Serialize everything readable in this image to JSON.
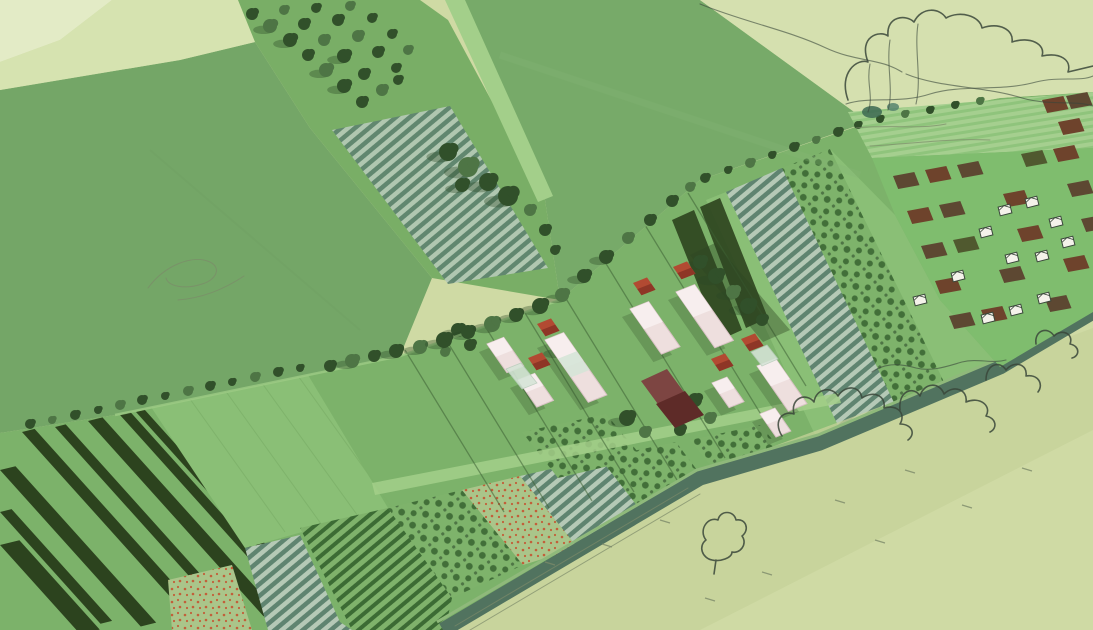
{
  "meta": {
    "title": "Agricultural masterplan aerial illustration",
    "description": "Hand-drawn style aerial perspective of a diagonal productive-landscape strip: striped field plots, orchards, polytunnels, allotments with sheds, farm courtyard buildings, hedgerows and sketched trees over pale meadow.",
    "type": "illustration",
    "has_text": false
  },
  "palette": {
    "paleBg": "#cfdaa4",
    "paleShade": "#c6d29a",
    "paleNE": "#d5e0af",
    "paleField1": "#e3ebc6",
    "paleField2": "#d6e3b0",
    "fieldGreen": "#74a667",
    "fieldGreenE": "#77aa69",
    "lightPath": "#a3cf8a",
    "stripGreen": "#7cb26a",
    "stripLight": "#8abf76",
    "darkStripe": "#2c431e",
    "hedge": "#3e6135",
    "treeDark": "#31502a",
    "treeMid": "#4e7545",
    "treeShadow": "#2c4724",
    "ridgeGreyDark": "#5f8470",
    "ridgeGreyLight": "#b5c9b6",
    "ridgeGreenDark": "#3c6b34",
    "ridgeGreenLight": "#7fb26b",
    "orchardBase": "#7eb36b",
    "orchardDot": "#426f39",
    "flowerBase": "#aac58a",
    "flowerDot": "#c25f3a",
    "allotGreen": "#7fbd6e",
    "brown1": "#5d4832",
    "brown2": "#6e432c",
    "brown3": "#50592f",
    "barnPink": "#eedfde",
    "barnTop": "#f7f0ef",
    "barnShade": "#d9c3c5",
    "glass": "#d5e4d7",
    "roofRed": "#b24a32",
    "roofRedDark": "#8e3626",
    "maroon": "#7d4542",
    "maroonDark": "#5e2b28",
    "bank": "#51735f",
    "bankHi": "#8fb97b",
    "ink": "#39463a",
    "faintInk": "#7c8a6a",
    "gStreakBase": "#a5cf8f",
    "gStreakLine": "#8fc47c",
    "shedWhite": "#f4f2ea"
  },
  "scene": {
    "stripes": [
      {
        "x": 22,
        "y": 432,
        "w": 13,
        "l": 235
      },
      {
        "x": 55,
        "y": 427,
        "w": 11,
        "l": 250
      },
      {
        "x": 88,
        "y": 421,
        "w": 15,
        "l": 262
      },
      {
        "x": 120,
        "y": 415,
        "w": 11,
        "l": 272
      },
      {
        "x": 136,
        "y": 412,
        "w": 9,
        "l": 280
      },
      {
        "x": 0,
        "y": 470,
        "w": 16,
        "l": 210
      },
      {
        "x": 0,
        "y": 512,
        "w": 12,
        "l": 150
      },
      {
        "x": 0,
        "y": 545,
        "w": 20,
        "l": 120
      }
    ],
    "barns": [
      {
        "x": 487,
        "y": 344,
        "l": 35,
        "w": 18
      },
      {
        "x": 545,
        "y": 340,
        "l": 76,
        "w": 20,
        "g": true
      },
      {
        "x": 518,
        "y": 380,
        "l": 33,
        "w": 18
      },
      {
        "x": 630,
        "y": 309,
        "l": 55,
        "w": 20
      },
      {
        "x": 676,
        "y": 292,
        "l": 68,
        "w": 20
      },
      {
        "x": 757,
        "y": 366,
        "l": 55,
        "w": 20
      },
      {
        "x": 712,
        "y": 383,
        "l": 30,
        "w": 16
      },
      {
        "x": 760,
        "y": 414,
        "l": 28,
        "w": 16
      }
    ],
    "glasshouses": [
      {
        "pts": "506,369 521,363 537,383 522,389"
      },
      {
        "pts": "751,352 767,345 778,359 762,366"
      }
    ],
    "cubes": [
      {
        "x": 537,
        "y": 324
      },
      {
        "x": 528,
        "y": 358
      },
      {
        "x": 633,
        "y": 283
      },
      {
        "x": 673,
        "y": 267
      },
      {
        "x": 711,
        "y": 359
      },
      {
        "x": 741,
        "y": 339
      }
    ],
    "maroon": {
      "body": "641,381 667,369 689,399 663,411",
      "gable": "656,404 685,391 704,415 675,428"
    },
    "sheds": [
      {
        "x": 1005,
        "y": 210
      },
      {
        "x": 1032,
        "y": 202
      },
      {
        "x": 1056,
        "y": 222
      },
      {
        "x": 986,
        "y": 232
      },
      {
        "x": 1012,
        "y": 258
      },
      {
        "x": 1042,
        "y": 256
      },
      {
        "x": 1068,
        "y": 242
      },
      {
        "x": 958,
        "y": 276
      },
      {
        "x": 988,
        "y": 318
      },
      {
        "x": 1016,
        "y": 310
      },
      {
        "x": 1044,
        "y": 298
      },
      {
        "x": 920,
        "y": 300
      }
    ],
    "patches": [
      {
        "x": 893,
        "y": 176,
        "c": "brown1"
      },
      {
        "x": 925,
        "y": 170,
        "c": "brown2"
      },
      {
        "x": 957,
        "y": 165,
        "c": "brown1"
      },
      {
        "x": 1021,
        "y": 154,
        "c": "brown3"
      },
      {
        "x": 1053,
        "y": 149,
        "c": "brown2"
      },
      {
        "x": 907,
        "y": 211,
        "c": "brown2"
      },
      {
        "x": 939,
        "y": 205,
        "c": "brown1"
      },
      {
        "x": 1003,
        "y": 194,
        "c": "brown2"
      },
      {
        "x": 1067,
        "y": 184,
        "c": "brown1"
      },
      {
        "x": 921,
        "y": 246,
        "c": "brown1"
      },
      {
        "x": 953,
        "y": 240,
        "c": "brown3"
      },
      {
        "x": 1017,
        "y": 229,
        "c": "brown2"
      },
      {
        "x": 1081,
        "y": 219,
        "c": "brown1"
      },
      {
        "x": 935,
        "y": 281,
        "c": "brown2"
      },
      {
        "x": 999,
        "y": 270,
        "c": "brown1"
      },
      {
        "x": 1063,
        "y": 259,
        "c": "brown2"
      },
      {
        "x": 949,
        "y": 316,
        "c": "brown1"
      },
      {
        "x": 981,
        "y": 310,
        "c": "brown2"
      },
      {
        "x": 1045,
        "y": 299,
        "c": "brown1"
      },
      {
        "x": 1042,
        "y": 100,
        "c": "brown2"
      },
      {
        "x": 1066,
        "y": 96,
        "c": "brown1"
      },
      {
        "x": 1058,
        "y": 122,
        "c": "brown2"
      }
    ],
    "trees_strip": [
      {
        "x": 458,
        "y": 330,
        "r": 7,
        "c": "d"
      },
      {
        "x": 470,
        "y": 345,
        "r": 6,
        "c": "d"
      },
      {
        "x": 445,
        "y": 352,
        "r": 5,
        "c": "m"
      },
      {
        "x": 560,
        "y": 350,
        "r": 7,
        "c": "m"
      },
      {
        "x": 578,
        "y": 366,
        "r": 6,
        "c": "d"
      },
      {
        "x": 700,
        "y": 262,
        "r": 7,
        "c": "d"
      },
      {
        "x": 716,
        "y": 276,
        "r": 8,
        "c": "d"
      },
      {
        "x": 733,
        "y": 292,
        "r": 7,
        "c": "m"
      },
      {
        "x": 748,
        "y": 306,
        "r": 8,
        "c": "d"
      },
      {
        "x": 762,
        "y": 320,
        "r": 6,
        "c": "d"
      },
      {
        "x": 627,
        "y": 418,
        "r": 8,
        "c": "d"
      },
      {
        "x": 645,
        "y": 432,
        "r": 6,
        "c": "m"
      },
      {
        "x": 695,
        "y": 400,
        "r": 7,
        "c": "d"
      },
      {
        "x": 710,
        "y": 418,
        "r": 6,
        "c": "m"
      },
      {
        "x": 680,
        "y": 430,
        "r": 6,
        "c": "d"
      }
    ],
    "trees_cover": [
      {
        "x": 30,
        "y": 424,
        "r": 5,
        "c": "d"
      },
      {
        "x": 52,
        "y": 420,
        "r": 4,
        "c": "m"
      },
      {
        "x": 75,
        "y": 415,
        "r": 5,
        "c": "d"
      },
      {
        "x": 98,
        "y": 410,
        "r": 4,
        "c": "d"
      },
      {
        "x": 120,
        "y": 405,
        "r": 5,
        "c": "m"
      },
      {
        "x": 142,
        "y": 400,
        "r": 5,
        "c": "d"
      },
      {
        "x": 165,
        "y": 396,
        "r": 4,
        "c": "d"
      },
      {
        "x": 188,
        "y": 391,
        "r": 5,
        "c": "m"
      },
      {
        "x": 210,
        "y": 386,
        "r": 5,
        "c": "d"
      },
      {
        "x": 232,
        "y": 382,
        "r": 4,
        "c": "d"
      },
      {
        "x": 255,
        "y": 377,
        "r": 5,
        "c": "m"
      },
      {
        "x": 278,
        "y": 372,
        "r": 5,
        "c": "d"
      },
      {
        "x": 300,
        "y": 368,
        "r": 4,
        "c": "d"
      },
      {
        "x": 330,
        "y": 366,
        "r": 6,
        "c": "d"
      },
      {
        "x": 352,
        "y": 361,
        "r": 7,
        "c": "m"
      },
      {
        "x": 374,
        "y": 356,
        "r": 6,
        "c": "d"
      },
      {
        "x": 396,
        "y": 351,
        "r": 7,
        "c": "d"
      },
      {
        "x": 420,
        "y": 347,
        "r": 7,
        "c": "m"
      },
      {
        "x": 444,
        "y": 340,
        "r": 8,
        "c": "d"
      },
      {
        "x": 468,
        "y": 332,
        "r": 7,
        "c": "d"
      },
      {
        "x": 492,
        "y": 324,
        "r": 8,
        "c": "m"
      },
      {
        "x": 516,
        "y": 315,
        "r": 7,
        "c": "d"
      },
      {
        "x": 540,
        "y": 306,
        "r": 8,
        "c": "d"
      },
      {
        "x": 562,
        "y": 295,
        "r": 7,
        "c": "m"
      },
      {
        "x": 584,
        "y": 276,
        "r": 7,
        "c": "d"
      },
      {
        "x": 606,
        "y": 257,
        "r": 7,
        "c": "d"
      },
      {
        "x": 628,
        "y": 238,
        "r": 6,
        "c": "m"
      },
      {
        "x": 650,
        "y": 220,
        "r": 6,
        "c": "d"
      },
      {
        "x": 672,
        "y": 201,
        "r": 6,
        "c": "d"
      },
      {
        "x": 690,
        "y": 187,
        "r": 5,
        "c": "m"
      },
      {
        "x": 705,
        "y": 178,
        "r": 5,
        "c": "d"
      },
      {
        "x": 728,
        "y": 170,
        "r": 4,
        "c": "d"
      },
      {
        "x": 750,
        "y": 163,
        "r": 5,
        "c": "m"
      },
      {
        "x": 772,
        "y": 155,
        "r": 4,
        "c": "d"
      },
      {
        "x": 794,
        "y": 147,
        "r": 5,
        "c": "d"
      },
      {
        "x": 816,
        "y": 140,
        "r": 4,
        "c": "m"
      },
      {
        "x": 838,
        "y": 132,
        "r": 5,
        "c": "d"
      },
      {
        "x": 858,
        "y": 125,
        "r": 4,
        "c": "d"
      },
      {
        "x": 880,
        "y": 119,
        "r": 4,
        "c": "d"
      },
      {
        "x": 905,
        "y": 114,
        "r": 4,
        "c": "m"
      },
      {
        "x": 930,
        "y": 110,
        "r": 4,
        "c": "d"
      },
      {
        "x": 955,
        "y": 105,
        "r": 4,
        "c": "d"
      },
      {
        "x": 980,
        "y": 101,
        "r": 4,
        "c": "m"
      },
      {
        "x": 252,
        "y": 14,
        "r": 6,
        "c": "d"
      },
      {
        "x": 270,
        "y": 26,
        "r": 7,
        "c": "m"
      },
      {
        "x": 290,
        "y": 40,
        "r": 7,
        "c": "d"
      },
      {
        "x": 308,
        "y": 55,
        "r": 6,
        "c": "d"
      },
      {
        "x": 326,
        "y": 70,
        "r": 7,
        "c": "m"
      },
      {
        "x": 344,
        "y": 86,
        "r": 7,
        "c": "d"
      },
      {
        "x": 362,
        "y": 102,
        "r": 6,
        "c": "d"
      },
      {
        "x": 284,
        "y": 10,
        "r": 5,
        "c": "m"
      },
      {
        "x": 304,
        "y": 24,
        "r": 6,
        "c": "d"
      },
      {
        "x": 324,
        "y": 40,
        "r": 6,
        "c": "m"
      },
      {
        "x": 344,
        "y": 56,
        "r": 7,
        "c": "d"
      },
      {
        "x": 364,
        "y": 74,
        "r": 6,
        "c": "d"
      },
      {
        "x": 382,
        "y": 90,
        "r": 6,
        "c": "m"
      },
      {
        "x": 316,
        "y": 8,
        "r": 5,
        "c": "d"
      },
      {
        "x": 338,
        "y": 20,
        "r": 6,
        "c": "d"
      },
      {
        "x": 358,
        "y": 36,
        "r": 6,
        "c": "m"
      },
      {
        "x": 378,
        "y": 52,
        "r": 6,
        "c": "d"
      },
      {
        "x": 396,
        "y": 68,
        "r": 5,
        "c": "d"
      },
      {
        "x": 350,
        "y": 6,
        "r": 5,
        "c": "m"
      },
      {
        "x": 372,
        "y": 18,
        "r": 5,
        "c": "d"
      },
      {
        "x": 392,
        "y": 34,
        "r": 5,
        "c": "d"
      },
      {
        "x": 408,
        "y": 50,
        "r": 5,
        "c": "m"
      },
      {
        "x": 398,
        "y": 80,
        "r": 5,
        "c": "d"
      },
      {
        "x": 448,
        "y": 152,
        "r": 9,
        "c": "d"
      },
      {
        "x": 468,
        "y": 167,
        "r": 10,
        "c": "m"
      },
      {
        "x": 488,
        "y": 182,
        "r": 9,
        "c": "d"
      },
      {
        "x": 508,
        "y": 196,
        "r": 10,
        "c": "d"
      },
      {
        "x": 462,
        "y": 185,
        "r": 7,
        "c": "d"
      },
      {
        "x": 530,
        "y": 210,
        "r": 6,
        "c": "m"
      },
      {
        "x": 545,
        "y": 230,
        "r": 6,
        "c": "d"
      },
      {
        "x": 555,
        "y": 250,
        "r": 5,
        "c": "d"
      }
    ],
    "marks": [
      {
        "x": 545,
        "y": 562
      },
      {
        "x": 602,
        "y": 544
      },
      {
        "x": 660,
        "y": 520
      },
      {
        "x": 835,
        "y": 500
      },
      {
        "x": 905,
        "y": 470
      },
      {
        "x": 962,
        "y": 505
      },
      {
        "x": 1022,
        "y": 468
      },
      {
        "x": 705,
        "y": 598
      },
      {
        "x": 762,
        "y": 572
      },
      {
        "x": 875,
        "y": 540
      }
    ]
  }
}
